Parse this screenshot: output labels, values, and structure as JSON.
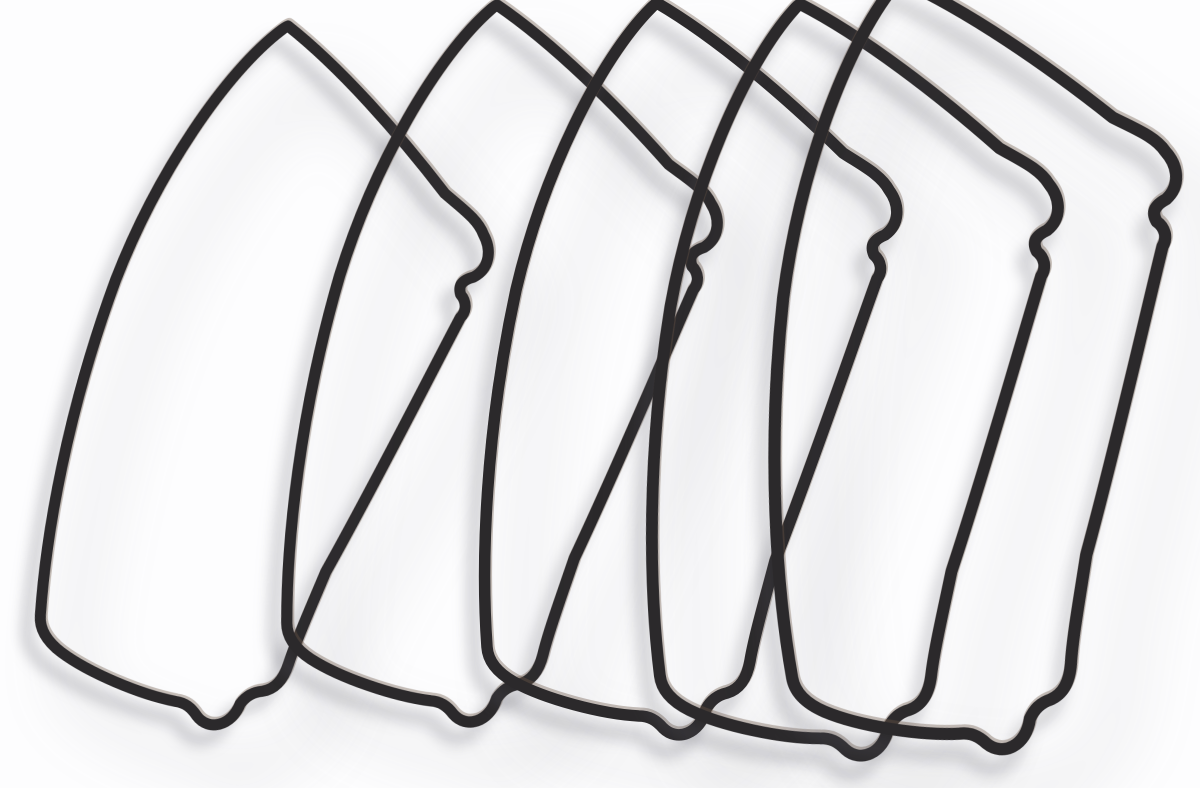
{
  "scene": {
    "type": "studio-product-photo",
    "subject": "Five black rubber rocker box cover gaskets fanned out and overlapping on a white background with soft gray shadows",
    "object_name": "rubber gasket seal",
    "object_count": 5,
    "canvas": {
      "width": 1200,
      "height": 788
    },
    "colors": {
      "background": "#fdfdfe",
      "gasket_rubber": "#2b292b",
      "gasket_sheen": "#6b5748",
      "shadow_near": "rgba(84,84,92,0.28)",
      "shadow_far": "rgba(98,98,106,0.24)"
    }
  },
  "gasket_template": {
    "path": "M 0 0 C 60 35 130 95 186 150 C 206 163 224 172 232 187 C 243 202 243 221 228 232 C 216 237 213 243 217 252 C 224 258 226 268 220 276 C 199 334 158 455 118 558 C 108 596 97 634 93 658 C 90 675 83 686 70 690 C 61 692 54 697 49 706 C 43 731 20 739 6 725 C -1 717 -8 713 -18 713 C -56 711 -112 696 -143 679 C -159 670 -169 659 -170 644 C -176 560 -172 430 -141 287 C -114 172 -58 57 -6 5 C -4 3 -2 1 0 0 Z",
    "stroke_width": 11.5,
    "sheen_stroke_width": 13,
    "sheen_offset_x": 1,
    "sheen_offset_y": -2
  },
  "gaskets": [
    {
      "id": "gasket-1",
      "x": 288,
      "y": 26,
      "rotate": 8,
      "scale": 0.96
    },
    {
      "id": "gasket-2",
      "x": 497,
      "y": 5,
      "rotate": 4,
      "scale": 0.98
    },
    {
      "id": "gasket-3",
      "x": 657,
      "y": 3,
      "rotate": 0,
      "scale": 1.0
    },
    {
      "id": "gasket-4",
      "x": 800,
      "y": 4,
      "rotate": -3,
      "scale": 1.03
    },
    {
      "id": "gasket-5",
      "x": 900,
      "y": -20,
      "rotate": -6,
      "scale": 1.06
    }
  ]
}
